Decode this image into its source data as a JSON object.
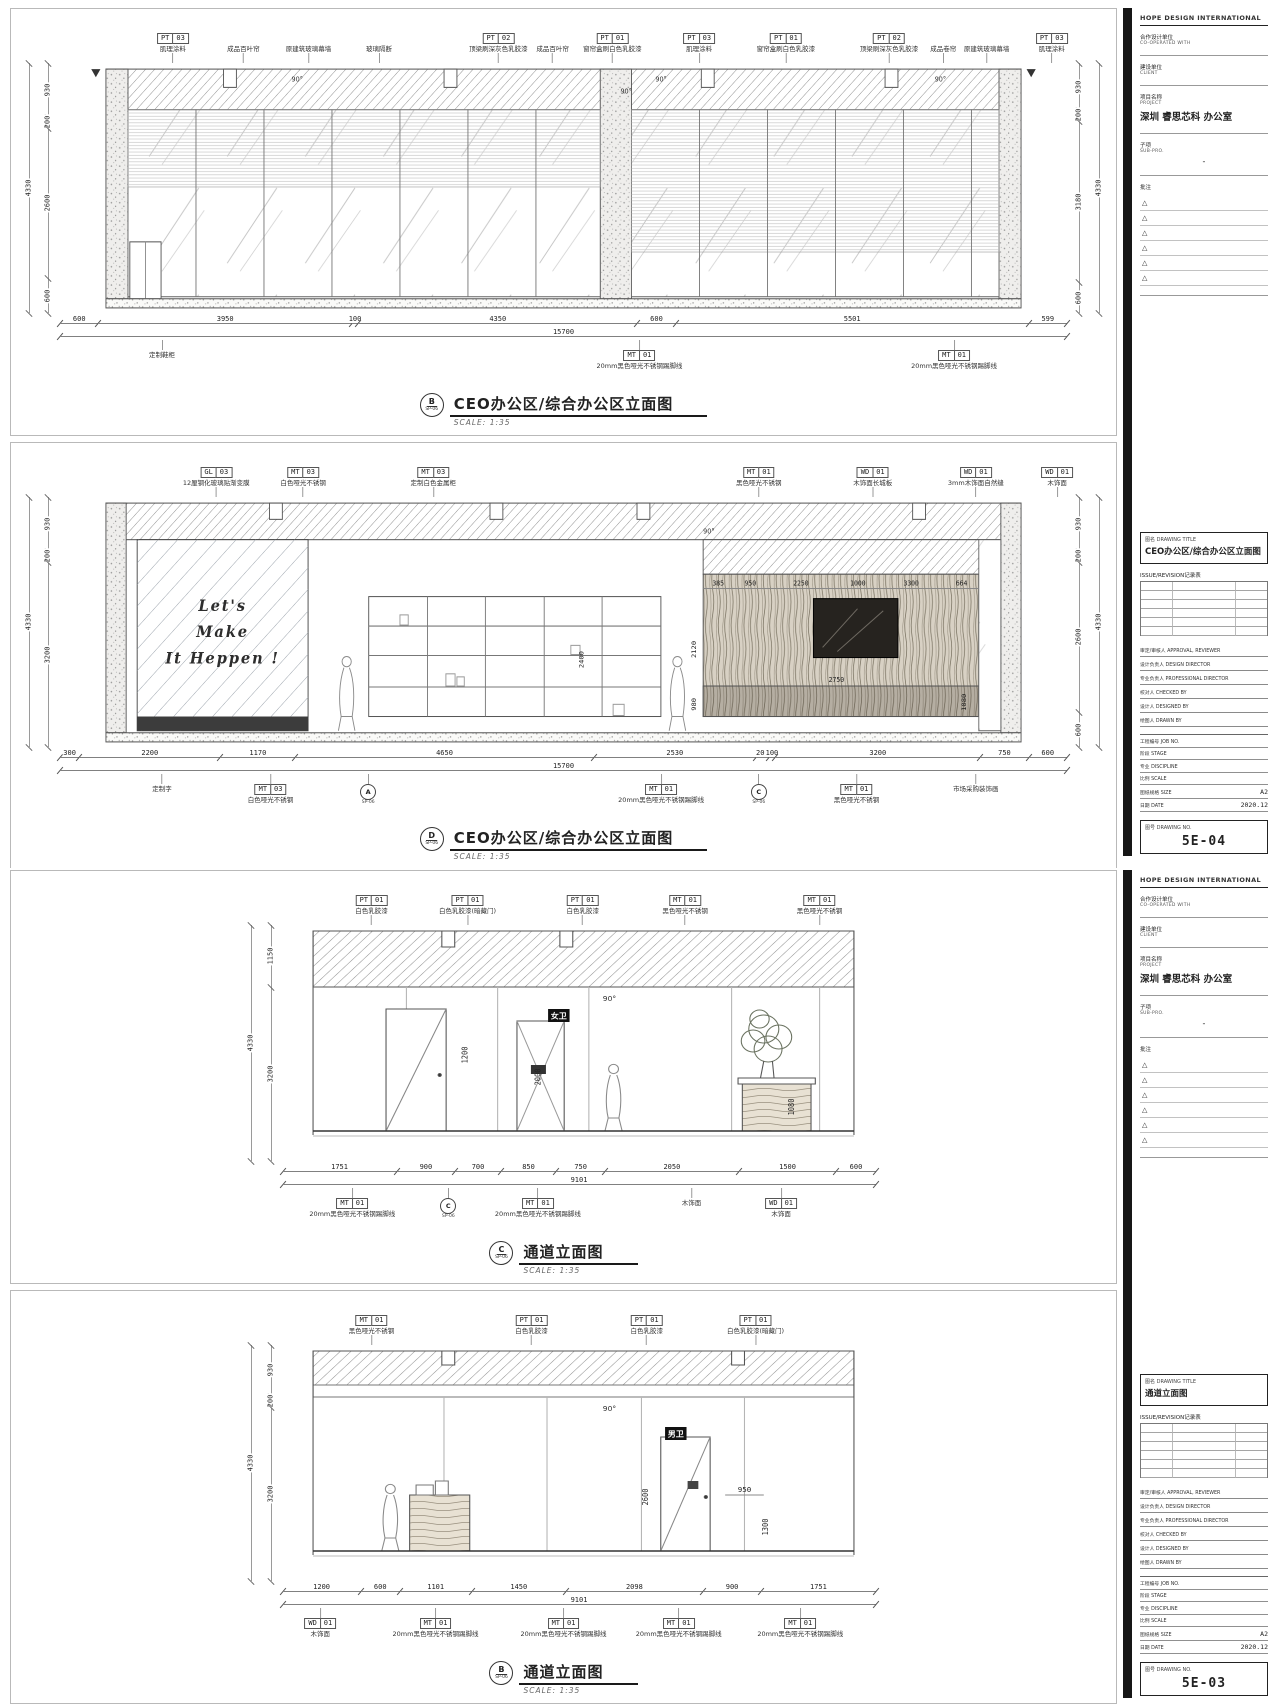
{
  "misc": {
    "angle": "90°"
  },
  "sheets": [
    {
      "sidebar": {
        "firm": "HOPE DESIGN INTERNATIONAL",
        "coop_label_cn": "合作设计单位",
        "coop_label_en": "CO-OPERATED WITH",
        "client_label_cn": "建设单位",
        "client_label_en": "CLIENT",
        "project_label_cn": "项目名称",
        "project_label_en": "PROJECT",
        "project_name": "深圳 睿思芯科 办公室",
        "sub_label_cn": "子项",
        "sub_label_en": "SUB-PRO.",
        "sub_value": "-",
        "notes_label": "批注",
        "notes": [
          "△",
          "△",
          "△",
          "△",
          "△",
          "△"
        ],
        "title_label_cn": "图名",
        "title_label_en": "DRAWING TITLE",
        "drawing_title": "CEO办公区/综合办公区立面图",
        "revision_label": "ISSUE/REVISION记录表",
        "roles": [
          {
            "t": "审定/审核人 APPROVAL, REVIEWER"
          },
          {
            "t": "设计负责人 DESIGN DIRECTOR"
          },
          {
            "t": "专业负责人 PROFESSIONAL DIRECTOR"
          },
          {
            "t": "校对人 CHECKED BY"
          },
          {
            "t": "设计人 DESIGNED BY"
          },
          {
            "t": "绘图人 DRAWN BY"
          }
        ],
        "meta": [
          {
            "l": "工程编号 JOB NO.",
            "val": ""
          },
          {
            "l": "阶段 STAGE",
            "val": ""
          },
          {
            "l": "专业 DISCIPLINE",
            "val": ""
          },
          {
            "l": "比例 SCALE",
            "val": ""
          },
          {
            "l": "图纸规格 SIZE",
            "val": "A2"
          },
          {
            "l": "日期 DATE",
            "val": "2020.12"
          }
        ],
        "no_label_cn": "图号",
        "no_label_en": "DRAWING NO.",
        "drawing_no": "5E-04"
      },
      "drawings": [
        {
          "name": "CEO办公区/综合办公区立面图",
          "scale": "SCALE: 1:35",
          "marker": "B",
          "marker_sub": "SP-06",
          "top_callouts": [
            {
              "x": 14,
              "code": "PT",
              "num": "03",
              "desc": "肌理涂料"
            },
            {
              "x": 20.5,
              "desc": "成品百叶帘"
            },
            {
              "x": 26.5,
              "desc": "原建筑玻璃幕墙"
            },
            {
              "x": 33,
              "desc": "玻璃隔断"
            },
            {
              "x": 44,
              "code": "PT",
              "num": "02",
              "desc": "顶梁刷深灰色乳胶漆"
            },
            {
              "x": 49,
              "desc": "成品百叶帘"
            },
            {
              "x": 54.5,
              "code": "PT",
              "num": "01",
              "desc": "窗帘盒刷白色乳胶漆"
            },
            {
              "x": 62.5,
              "code": "PT",
              "num": "03",
              "desc": "肌理涂料"
            },
            {
              "x": 70.5,
              "code": "PT",
              "num": "01",
              "desc": "窗帘盒刷白色乳胶漆"
            },
            {
              "x": 80,
              "code": "PT",
              "num": "02",
              "desc": "顶梁刷深灰色乳胶漆"
            },
            {
              "x": 85,
              "desc": "成品卷帘"
            },
            {
              "x": 89,
              "desc": "原建筑玻璃幕墙"
            },
            {
              "x": 95,
              "code": "PT",
              "num": "03",
              "desc": "肌理涂料"
            }
          ],
          "left_dims": [
            {
              "v": 930,
              "t": "930"
            },
            {
              "v": 200,
              "t": "200"
            },
            {
              "v": 2600,
              "t": "2600"
            },
            {
              "v": 600,
              "t": "600"
            }
          ],
          "left_total": "4330",
          "right_dims": [
            {
              "v": 930,
              "t": "930"
            },
            {
              "v": 200,
              "t": "200"
            },
            {
              "v": 3180,
              "t": "3180"
            },
            {
              "v": 600,
              "t": "600"
            }
          ],
          "right_total": "4330",
          "bottom_dims": [
            {
              "v": 600,
              "t": "600"
            },
            {
              "v": 3950,
              "t": "3950"
            },
            {
              "v": 100,
              "t": "100"
            },
            {
              "v": 4350,
              "t": "4350"
            },
            {
              "v": 600,
              "t": "600"
            },
            {
              "v": 5501,
              "t": "5501"
            },
            {
              "v": 599,
              "t": "599"
            }
          ],
          "bottom_total": "15700",
          "bottom_callouts": [
            {
              "x": 13,
              "desc": "定制鞋柜"
            },
            {
              "x": 57,
              "code": "MT",
              "num": "01",
              "desc": "20mm黑色哑光不锈钢踢脚线"
            },
            {
              "x": 86,
              "code": "MT",
              "num": "01",
              "desc": "20mm黑色哑光不锈钢踢脚线"
            }
          ]
        },
        {
          "name": "CEO办公区/综合办公区立面图",
          "scale": "SCALE: 1:35",
          "marker": "D",
          "marker_sub": "SP-06",
          "top_callouts": [
            {
              "x": 18,
              "code": "GL",
              "num": "03",
              "desc": "12厘钢化玻璃贴渐变膜"
            },
            {
              "x": 26,
              "code": "MT",
              "num": "03",
              "desc": "白色哑光不锈钢"
            },
            {
              "x": 38,
              "code": "MT",
              "num": "03",
              "desc": "定制白色金属柜"
            },
            {
              "x": 68,
              "code": "MT",
              "num": "01",
              "desc": "黑色哑光不锈钢"
            },
            {
              "x": 78.5,
              "code": "WD",
              "num": "01",
              "desc": "木饰面长城板"
            },
            {
              "x": 88,
              "code": "WD",
              "num": "01",
              "desc": "3mm木饰面自然缝"
            },
            {
              "x": 95.5,
              "code": "WD",
              "num": "01",
              "desc": "木饰面"
            }
          ],
          "left_dims": [
            {
              "v": 930,
              "t": "930"
            },
            {
              "v": 200,
              "t": "200"
            },
            {
              "v": 3200,
              "t": "3200"
            }
          ],
          "left_total": "4330",
          "right_dims": [
            {
              "v": 930,
              "t": "930"
            },
            {
              "v": 200,
              "t": "200"
            },
            {
              "v": 2600,
              "t": "2600"
            },
            {
              "v": 600,
              "t": "600"
            }
          ],
          "right_total": "4330",
          "interior": {
            "slogan": [
              "Let's",
              "Make",
              "It Heppen !"
            ],
            "top_dims": [
              "385",
              "950",
              "2250",
              "1000",
              "3300",
              "664"
            ],
            "dims": [
              "2120",
              "2400",
              "980",
              "2750",
              "1080"
            ]
          },
          "bottom_dims": [
            {
              "v": 300,
              "t": "300"
            },
            {
              "v": 2200,
              "t": "2200"
            },
            {
              "v": 1170,
              "t": "1170"
            },
            {
              "v": 4650,
              "t": "4650"
            },
            {
              "v": 2530,
              "t": "2530"
            },
            {
              "v": 200,
              "t": "200"
            },
            {
              "v": 100,
              "t": "100"
            },
            {
              "v": 3200,
              "t": "3200"
            },
            {
              "v": 750,
              "t": "750"
            },
            {
              "v": 600,
              "t": "600"
            }
          ],
          "bottom_total": "15700",
          "bottom_callouts": [
            {
              "x": 13,
              "desc": "定制字"
            },
            {
              "x": 23,
              "code": "MT",
              "num": "03",
              "desc": "白色哑光不锈钢"
            },
            {
              "x": 32,
              "circle": "A",
              "sub": "SP-06"
            },
            {
              "x": 59,
              "code": "MT",
              "num": "01",
              "desc": "20mm黑色哑光不锈钢踢脚线"
            },
            {
              "x": 68,
              "circle": "C",
              "sub": "SP-06"
            },
            {
              "x": 77,
              "code": "MT",
              "num": "01",
              "desc": "黑色哑光不锈钢"
            },
            {
              "x": 88,
              "desc": "市场采购装饰画"
            }
          ]
        }
      ]
    },
    {
      "sidebar": {
        "firm": "HOPE DESIGN INTERNATIONAL",
        "coop_label_cn": "合作设计单位",
        "coop_label_en": "CO-OPERATED WITH",
        "client_label_cn": "建设单位",
        "client_label_en": "CLIENT",
        "project_label_cn": "项目名称",
        "project_label_en": "PROJECT",
        "project_name": "深圳 睿思芯科 办公室",
        "sub_label_cn": "子项",
        "sub_label_en": "SUB-PRO.",
        "sub_value": "-",
        "notes_label": "批注",
        "notes": [
          "△",
          "△",
          "△",
          "△",
          "△",
          "△"
        ],
        "title_label_cn": "图名",
        "title_label_en": "DRAWING TITLE",
        "drawing_title": "通道立面图",
        "revision_label": "ISSUE/REVISION记录表",
        "roles": [
          {
            "t": "审定/审核人 APPROVAL, REVIEWER"
          },
          {
            "t": "设计负责人 DESIGN DIRECTOR"
          },
          {
            "t": "专业负责人 PROFESSIONAL DIRECTOR"
          },
          {
            "t": "校对人 CHECKED BY"
          },
          {
            "t": "设计人 DESIGNED BY"
          },
          {
            "t": "绘图人 DRAWN BY"
          }
        ],
        "meta": [
          {
            "l": "工程编号 JOB NO.",
            "val": ""
          },
          {
            "l": "阶段 STAGE",
            "val": ""
          },
          {
            "l": "专业 DISCIPLINE",
            "val": ""
          },
          {
            "l": "比例 SCALE",
            "val": ""
          },
          {
            "l": "图纸规格 SIZE",
            "val": "A2"
          },
          {
            "l": "日期 DATE",
            "val": "2020.12"
          }
        ],
        "no_label_cn": "图号",
        "no_label_en": "DRAWING NO.",
        "drawing_no": "5E-03"
      },
      "drawings": [
        {
          "name": "通道立面图",
          "scale": "SCALE: 1:35",
          "marker": "C",
          "marker_sub": "SP-06",
          "top_callouts": [
            {
              "x": 20,
              "code": "PT",
              "num": "01",
              "desc": "白色乳胶漆"
            },
            {
              "x": 35,
              "code": "PT",
              "num": "01",
              "desc": "白色乳胶漆(暗藏门)"
            },
            {
              "x": 53,
              "code": "PT",
              "num": "01",
              "desc": "白色乳胶漆"
            },
            {
              "x": 69,
              "code": "MT",
              "num": "01",
              "desc": "黑色哑光不锈钢"
            },
            {
              "x": 90,
              "code": "MT",
              "num": "01",
              "desc": "黑色哑光不锈钢"
            }
          ],
          "left_dims": [
            {
              "v": 1150,
              "t": "1150"
            },
            {
              "v": 3200,
              "t": "3200"
            }
          ],
          "left_total": "4330",
          "interior": {
            "room": "女卫",
            "dims": [
              "1200",
              "2000",
              "1080"
            ]
          },
          "bottom_dims": [
            {
              "v": 1751,
              "t": "1751"
            },
            {
              "v": 900,
              "t": "900"
            },
            {
              "v": 700,
              "t": "700"
            },
            {
              "v": 850,
              "t": "850"
            },
            {
              "v": 750,
              "t": "750"
            },
            {
              "v": 2050,
              "t": "2050"
            },
            {
              "v": 1500,
              "t": "1500"
            },
            {
              "v": 600,
              "t": "600"
            }
          ],
          "bottom_total": "9101",
          "bottom_callouts": [
            {
              "x": 17,
              "code": "MT",
              "num": "01",
              "desc": "20mm黑色哑光不锈钢踢脚线"
            },
            {
              "x": 32,
              "circle": "C",
              "sub": "SP-06"
            },
            {
              "x": 46,
              "code": "MT",
              "num": "01",
              "desc": "20mm黑色哑光不锈钢踢脚线"
            },
            {
              "x": 70,
              "desc": "木饰面"
            },
            {
              "x": 84,
              "code": "WD",
              "num": "01",
              "desc": "木饰面"
            }
          ]
        },
        {
          "name": "通道立面图",
          "scale": "SCALE: 1:35",
          "marker": "B",
          "marker_sub": "SP-06",
          "top_callouts": [
            {
              "x": 20,
              "code": "MT",
              "num": "01",
              "desc": "黑色哑光不锈钢"
            },
            {
              "x": 45,
              "code": "PT",
              "num": "01",
              "desc": "白色乳胶漆"
            },
            {
              "x": 63,
              "code": "PT",
              "num": "01",
              "desc": "白色乳胶漆"
            },
            {
              "x": 80,
              "code": "PT",
              "num": "01",
              "desc": "白色乳胶漆(暗藏门)"
            }
          ],
          "left_dims": [
            {
              "v": 930,
              "t": "930"
            },
            {
              "v": 200,
              "t": "200"
            },
            {
              "v": 3200,
              "t": "3200"
            }
          ],
          "left_total": "4330",
          "interior": {
            "room": "男卫",
            "dims": [
              "2600",
              "950",
              "1300"
            ]
          },
          "bottom_dims": [
            {
              "v": 1200,
              "t": "1200"
            },
            {
              "v": 600,
              "t": "600"
            },
            {
              "v": 1101,
              "t": "1101"
            },
            {
              "v": 1450,
              "t": "1450"
            },
            {
              "v": 2098,
              "t": "2098"
            },
            {
              "v": 900,
              "t": "900"
            },
            {
              "v": 1751,
              "t": "1751"
            }
          ],
          "bottom_total": "9101",
          "bottom_callouts": [
            {
              "x": 12,
              "code": "WD",
              "num": "01",
              "desc": "木饰面"
            },
            {
              "x": 30,
              "code": "MT",
              "num": "01",
              "desc": "20mm黑色哑光不锈钢踢脚线"
            },
            {
              "x": 50,
              "code": "MT",
              "num": "01",
              "desc": "20mm黑色哑光不锈钢踢脚线"
            },
            {
              "x": 68,
              "code": "MT",
              "num": "01",
              "desc": "20mm黑色哑光不锈钢踢脚线"
            },
            {
              "x": 87,
              "code": "MT",
              "num": "01",
              "desc": "20mm黑色哑光不锈钢踢脚线"
            }
          ]
        }
      ]
    }
  ]
}
